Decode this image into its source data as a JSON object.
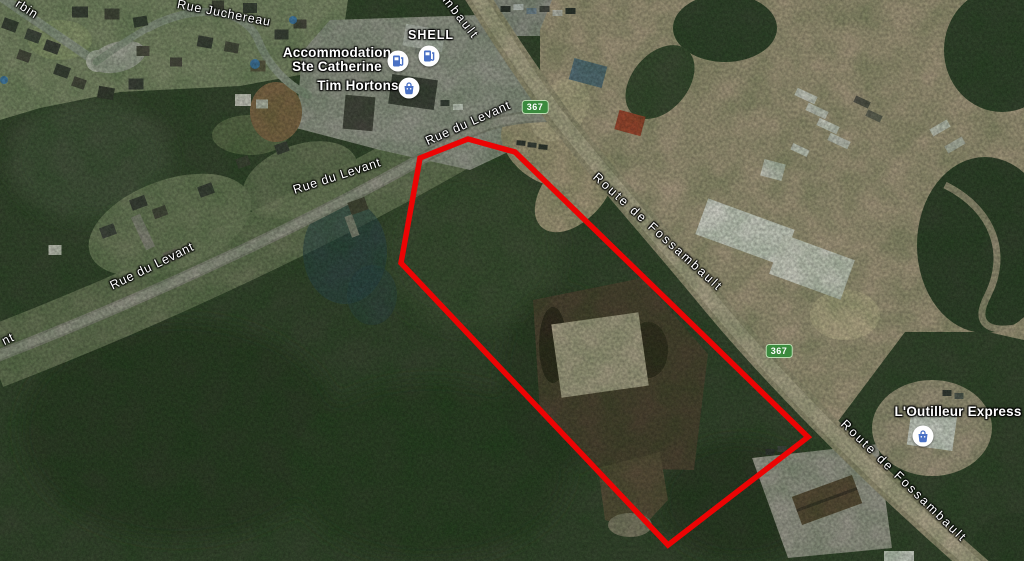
{
  "pois": {
    "shell": "SHELL",
    "accommodation_line1": "Accommodation",
    "accommodation_line2": "Ste Catherine",
    "tim_hortons": "Tim Hortons",
    "outilleur": "L'Outilleur Express"
  },
  "streets": {
    "levant": "Rue du Levant",
    "levant_partial": "nt",
    "juchereau": "Rue Juchereau",
    "fossambault": "Route de Fossambault",
    "fossambault_partial": "Fossambault",
    "street_partial_topleft": "rbin"
  },
  "badges": {
    "route_367": "367"
  },
  "icons": {
    "gas_pump": "gas-pump-icon",
    "shopping_bag": "shopping-bag-icon"
  },
  "colors": {
    "parcel_outline_red": "#ec0404",
    "route_badge_green": "#3b8a3e",
    "poi_icon_blue": "#4a71c4",
    "forest_base": "#35422c"
  },
  "overlay": {
    "parcel_outline_points": "420,158 468,139 515,152 808,437 668,545 401,263"
  }
}
